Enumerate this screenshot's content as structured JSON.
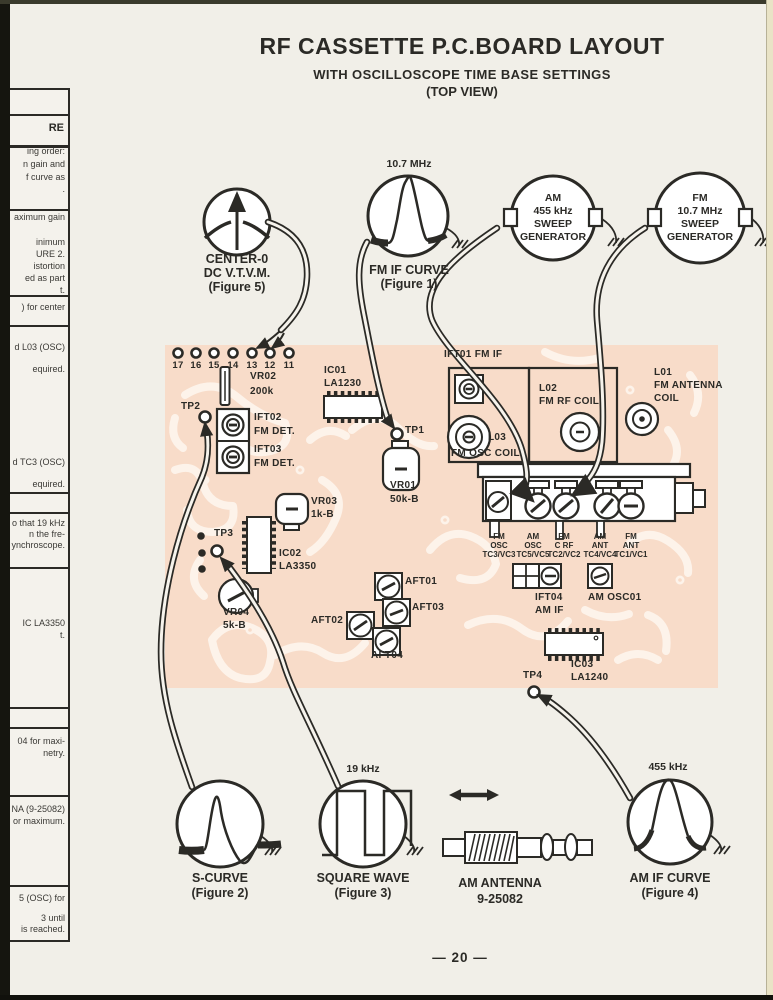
{
  "title": {
    "line1": "RF CASSETTE P.C.BOARD LAYOUT",
    "line2": "WITH OSCILLOSCOPE TIME BASE SETTINGS",
    "line3": "(TOP VIEW)"
  },
  "page_number": "— 20 —",
  "colors": {
    "ink": "#2b2a26",
    "board": "#f8dcc9",
    "trace": "#fdf3ea"
  },
  "sidebar": {
    "header": "RE",
    "fragments": [
      "ing order:",
      "n gain and",
      "f curve as",
      ".",
      "aximum gain",
      "inimum",
      "URE 2.",
      "istortion",
      "ed as part",
      "t.",
      ") for center",
      "d L03 (OSC)",
      "equired.",
      "d TC3 (OSC)",
      "equired.",
      "o that 19 kHz",
      "n the fre-",
      "ynchroscope.",
      "IC LA3350",
      "t.",
      "04 for maxi-",
      "netry.",
      "NA (9-25082)",
      "or maximum.",
      "5 (OSC) for",
      "3 until",
      "is reached."
    ]
  },
  "instruments": {
    "vtvm": {
      "name": "CENTER-0",
      "name2": "DC V.T.V.M.",
      "fig": "(Figure 5)"
    },
    "fm_if": {
      "freq": "10.7 MHz",
      "name": "FM IF CURVE",
      "fig": "(Figure 1)"
    },
    "am_sweep": {
      "l1": "AM",
      "l2": "455 kHz",
      "l3": "SWEEP",
      "l4": "GENERATOR"
    },
    "fm_sweep": {
      "l1": "FM",
      "l2": "10.7 MHz",
      "l3": "SWEEP",
      "l4": "GENERATOR"
    },
    "s_curve": {
      "name": "S-CURVE",
      "fig": "(Figure 2)"
    },
    "square_wave": {
      "freq": "19 kHz",
      "name": "SQUARE WAVE",
      "fig": "(Figure 3)"
    },
    "am_antenna": {
      "name": "AM ANTENNA",
      "part": "9-25082"
    },
    "am_if": {
      "freq": "455 kHz",
      "name": "AM IF CURVE",
      "fig": "(Figure 4)"
    }
  },
  "board": {
    "pins": [
      "17",
      "16",
      "15",
      "14",
      "13",
      "12",
      "11"
    ],
    "vr02": [
      "VR02",
      "200k"
    ],
    "tp1": "TP1",
    "tp2": "TP2",
    "tp3": "TP3",
    "tp4": "TP4",
    "ift02": [
      "IFT02",
      "FM DET."
    ],
    "ift03": [
      "IFT03",
      "FM DET."
    ],
    "ic01": [
      "IC01",
      "LA1230"
    ],
    "vr01": [
      "VR01",
      "50k-B"
    ],
    "ift01": "IFT01 FM IF",
    "l02": [
      "L02",
      "FM RF COIL"
    ],
    "l01": [
      "L01",
      "FM ANTENNA",
      "COIL"
    ],
    "l03": [
      "L03",
      "FM OSC COIL"
    ],
    "vr03": [
      "VR03",
      "1k-B"
    ],
    "ic02": [
      "IC02",
      "LA3350"
    ],
    "vr04": [
      "VR04",
      "5k-B"
    ],
    "aft01": "AFT01",
    "aft02": "AFT02",
    "aft03": "AFT03",
    "aft04": "AFT04",
    "gang": [
      [
        "FM",
        "OSC",
        "TC3/VC3"
      ],
      [
        "AM",
        "OSC",
        "TC5/VC5"
      ],
      [
        "FM",
        "C RF",
        "TC2/VC2"
      ],
      [
        "AM",
        "ANT",
        "TC4/VC4"
      ],
      [
        "FM",
        "ANT",
        "TC1/VC1"
      ]
    ],
    "ift04": [
      "IFT04",
      "AM IF"
    ],
    "am_osc01": "AM OSC01",
    "ic03": [
      "IC03",
      "LA1240"
    ]
  }
}
